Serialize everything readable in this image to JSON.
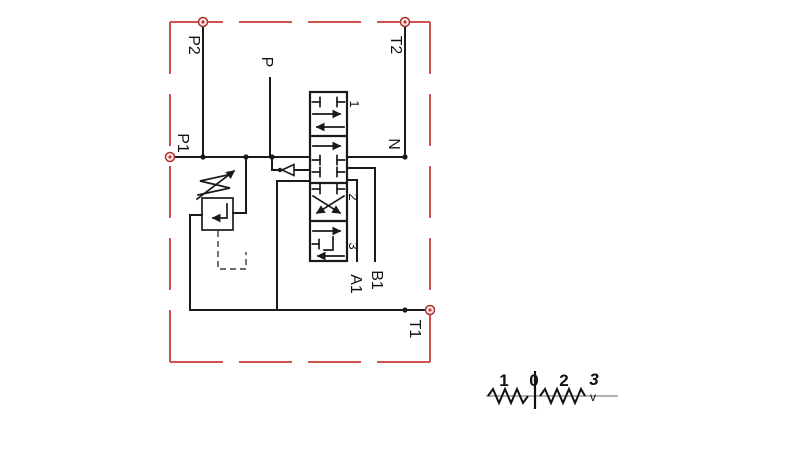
{
  "diagram": {
    "ports": {
      "p2": "P2",
      "t2": "T2",
      "p": "P",
      "p1": "P1",
      "n": "N",
      "a1": "A1",
      "b1": "B1",
      "t1": "T1"
    },
    "valve_positions": {
      "pos1": "1",
      "pos2": "2",
      "pos3": "3"
    },
    "legend": {
      "left_position": "1",
      "center_position": "0",
      "right_position": "2",
      "detent_position": "3",
      "detent_mark": "v"
    },
    "colors": {
      "line": "#1a1a1a",
      "frame_red": "#cc3b35",
      "legend_axis": "#999999",
      "background": "#ffffff"
    }
  }
}
